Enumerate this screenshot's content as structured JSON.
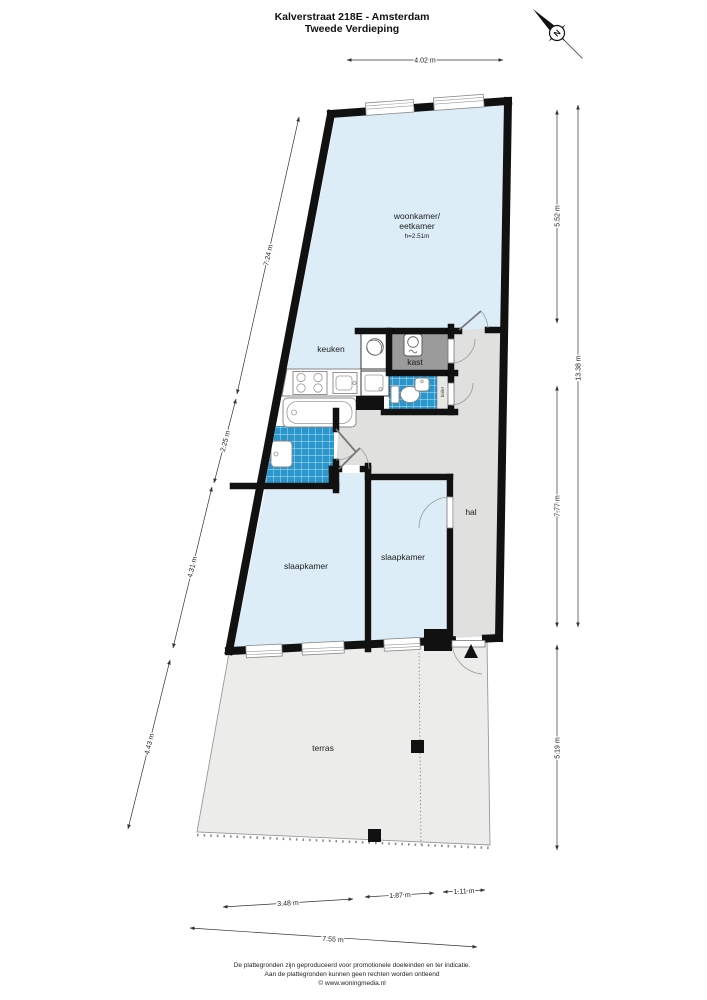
{
  "header": {
    "title_line1": "Kalverstraat 218E - Amsterdam",
    "title_line2": "Tweede Verdieping"
  },
  "compass": {
    "north_label": "N"
  },
  "rooms": {
    "woonkamer_line1": "woonkamer/",
    "woonkamer_line2": "eetkamer",
    "woonkamer_height": "h=2.51m",
    "keuken": "keuken",
    "kast": "kast",
    "boiler": "boiler",
    "hal": "hal",
    "slaapkamer_left": "slaapkamer",
    "slaapkamer_right": "slaapkamer",
    "terras": "terras"
  },
  "dimensions": {
    "top": "4.02 m",
    "left_upper": "7.24 m",
    "left_mid": "2.25 m",
    "left_lower": "4.31 m",
    "left_terras": "4.43 m",
    "right_woonkamer": "5.52 m",
    "right_total": "13.38 m",
    "right_hal": "7.77 m",
    "right_terras": "5.19 m",
    "bottom_seg1": "3.48 m",
    "bottom_seg2": "1.87 m",
    "bottom_seg3": "1.11 m",
    "bottom_total": "7.55 m"
  },
  "footer": {
    "line1": "De plattegronden zijn geproduceerd voor promotionele doeleinden en ter indicatie.",
    "line2": "Aan de plattegronden kunnen geen rechten worden ontleend",
    "line3": "© www.woningmedia.nl"
  },
  "colors": {
    "room_fill": "#dcedf7",
    "tile_fill": "#2a96cc",
    "kast_fill": "#9b9b9b",
    "hal_fill": "#e0e0de",
    "terras_fill": "#ececea",
    "wall": "#111111"
  }
}
